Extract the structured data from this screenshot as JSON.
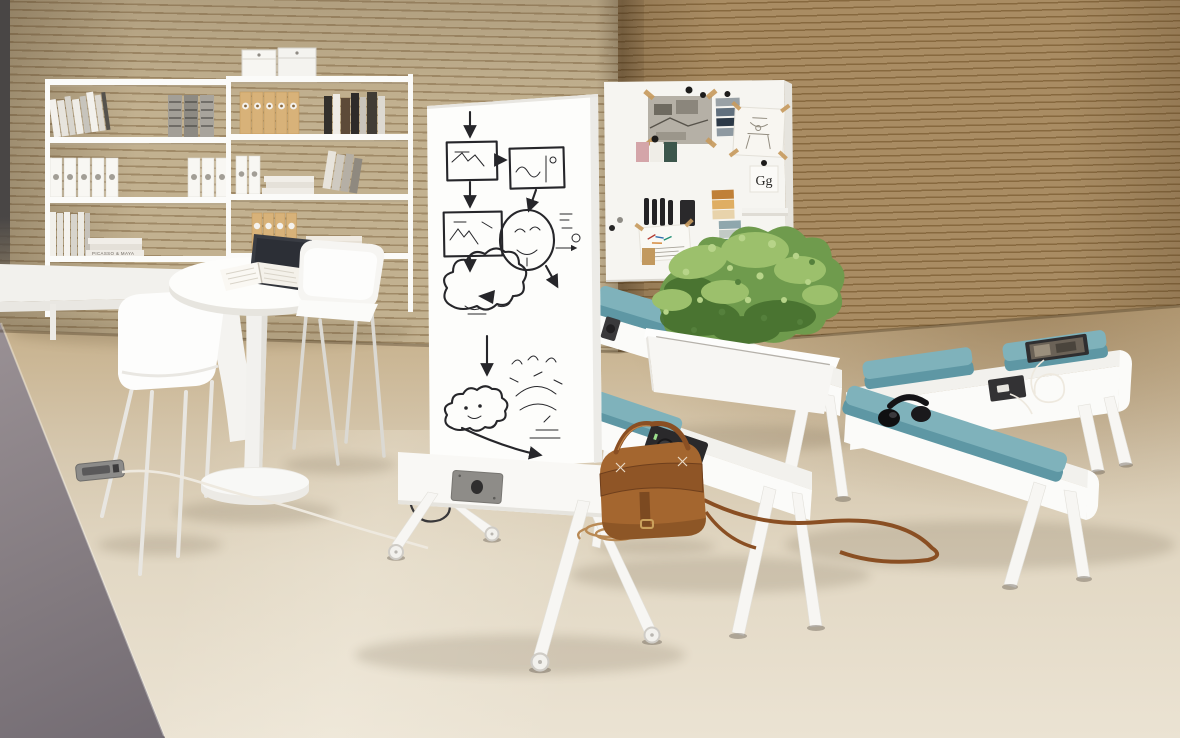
{
  "scene": {
    "description": "Modern office breakout area: white shelving with books and binders, round meeting table with laptop and open book, white chairs, mobile whiteboard with hand-drawn flowchart, mood pin-board, zig-zag white benches with teal cushions and built-in power outlets, planter with green shrubs, leather satchel and headphones",
    "objects": [
      "bookshelf",
      "storage-boxes",
      "wall-desk",
      "molded-chair",
      "side-chair",
      "round-table",
      "laptop",
      "open-book",
      "mobile-whiteboard",
      "whiteboard-flowchart",
      "mood-board",
      "planter-box",
      "plant",
      "bench",
      "bench-cushion",
      "power-outlet",
      "leather-bag",
      "headphones",
      "tablet-on-bench",
      "magazine",
      "floor-outlet",
      "power-cable",
      "coiled-cable"
    ]
  },
  "texts": {
    "book_spine": "PICASSO & MAYA",
    "type_card": "Gg"
  },
  "colors": {
    "wallL": "#c2b190",
    "wallLline": "#a08a67",
    "wallR": "#a98c63",
    "wallRline": "#87693f",
    "edgeDark": "#494645",
    "rampTop": "#9a9195",
    "rampBottom": "#6c656d",
    "floorBack": "#bda37b",
    "floorFront": "#ebe3d3",
    "furnitureWhite": "#fbfbf9",
    "cushion": "#7fb2bb",
    "cushionShade": "#5e97a4",
    "plantLight": "#9cc06c",
    "plant": "#6f9b4d",
    "plantDark": "#47702f",
    "bag": "#a4662f",
    "bagDark": "#7c4a21",
    "ink": "#26262a",
    "outletDark": "#2a292b",
    "outletGray": "#8c8b89",
    "binderTan": "#d8b279",
    "cableWhite": "#eee9df"
  }
}
